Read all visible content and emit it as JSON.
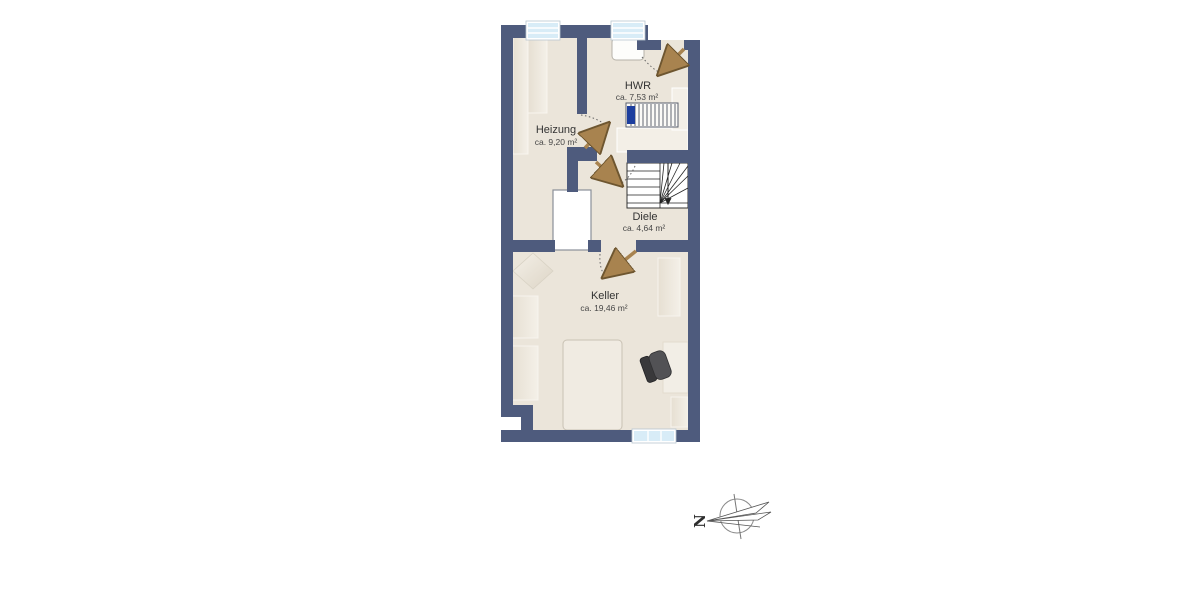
{
  "floorplan": {
    "title": "basement-floor-plan",
    "rooms": [
      {
        "id": "heizung",
        "name": "Heizung",
        "area": "ca. 9,20 m²"
      },
      {
        "id": "hwr",
        "name": "HWR",
        "area": "ca. 7,53 m²"
      },
      {
        "id": "diele",
        "name": "Diele",
        "area": "ca. 4,64 m²"
      },
      {
        "id": "keller",
        "name": "Keller",
        "area": "ca. 19,46 m²"
      }
    ],
    "compass": {
      "label": "N"
    },
    "colors": {
      "wall": "#4e5b7d",
      "floor": "#ebe5da",
      "door_leaf": "#a8834f",
      "window_glass": "#d8ecf7",
      "furniture_light": "#efe9df",
      "appliance_accent": "#1d3e9e",
      "chair_dark": "#4a4a4c",
      "stair_line": "#222222"
    },
    "objects": [
      "window",
      "window",
      "window",
      "entry-door",
      "interior-door",
      "interior-door",
      "interior-door",
      "winder-stairs",
      "radiator",
      "laundry-appliance",
      "shelf",
      "shelf",
      "shelf",
      "shelf",
      "bed",
      "desk",
      "office-chair",
      "side-table",
      "shaft-box",
      "compass-rose"
    ]
  }
}
